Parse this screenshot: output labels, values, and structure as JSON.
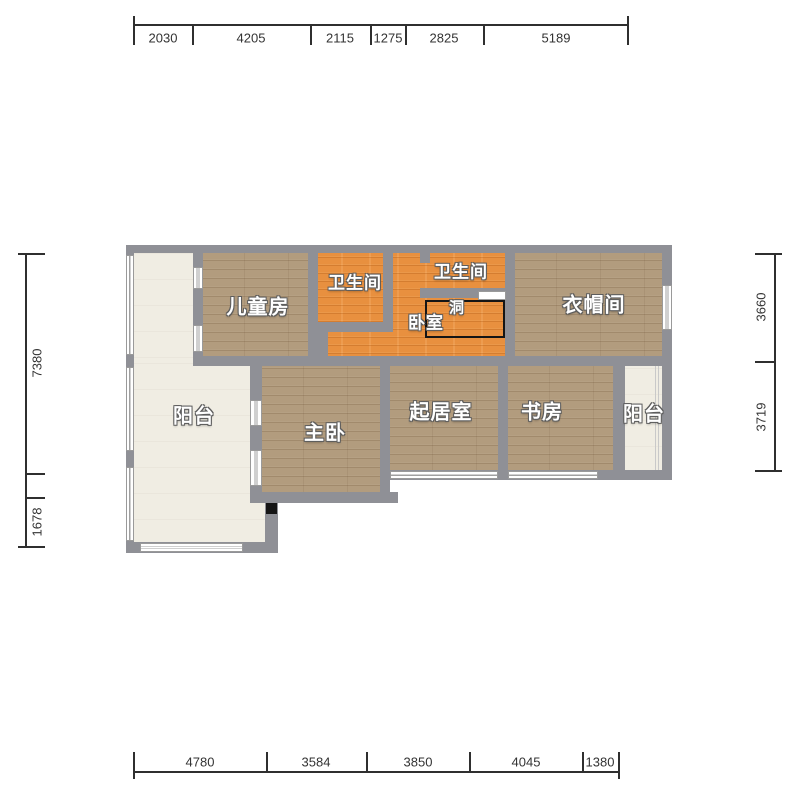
{
  "floorplan": {
    "title": "apartment-floor-plan",
    "rooms": {
      "children_room": "儿童房",
      "bathroom_1": "卫生间",
      "bathroom_2": "卫生间",
      "bedroom": "卧室",
      "hole": "洞",
      "cloakroom": "衣帽间",
      "balcony_left": "阳台",
      "balcony_right": "阳台",
      "master_bedroom": "主卧",
      "living_room": "起居室",
      "study": "书房"
    },
    "dimensions": {
      "top": [
        "2030",
        "4205",
        "2115",
        "1275",
        "2825",
        "5189"
      ],
      "bottom": [
        "4780",
        "3584",
        "3850",
        "4045",
        "1380"
      ],
      "left": [
        "7380",
        "1678"
      ],
      "right": [
        "3660",
        "3719"
      ]
    },
    "colors": {
      "wall": "#8f9096",
      "wood_floor": "#b29c7e",
      "orange_floor": "#e8903f",
      "balcony_floor": "#f0ede3",
      "dimension_text": "#333333"
    }
  }
}
